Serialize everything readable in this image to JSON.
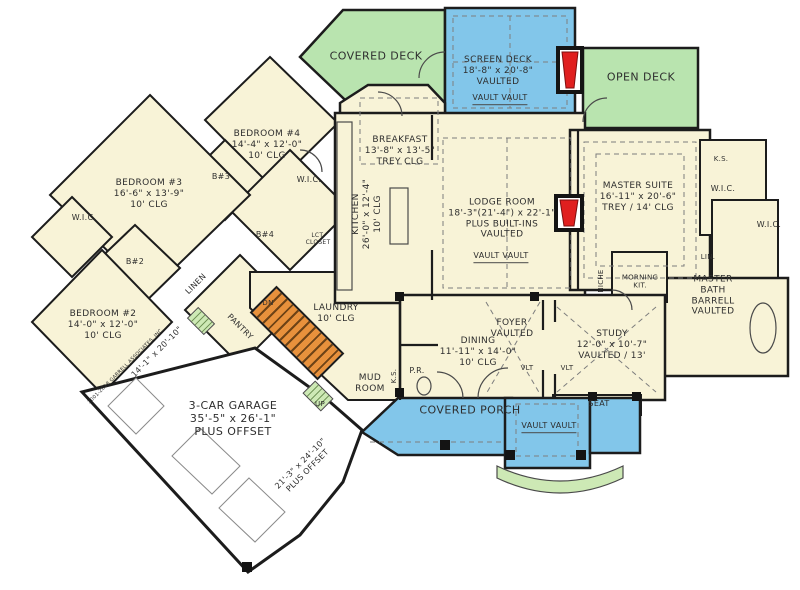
{
  "plan": {
    "decks": {
      "covered_deck": "COVERED DECK",
      "screen_deck": "SCREEN DECK\n18'-8\" x 20'-8\"\nVAULTED",
      "screen_deck_vault": "VAULT   VAULT",
      "open_deck": "OPEN DECK"
    },
    "rooms": {
      "breakfast": "BREAKFAST\n13'-8\" x 13'-5\"\nTREY CLG",
      "kitchen": "KITCHEN\n26'-0\" x 12'-4\"\n10' CLG",
      "lodge": "LODGE ROOM\n18'-3\"(21'-4\") x 22'-1\"\nPLUS BUILT-INS\nVAULTED",
      "lodge_vault": "VAULT   VAULT",
      "master_suite": "MASTER SUITE\n16'-11\" x 20'-6\"\nTREY / 14' CLG",
      "master_bath": "MASTER\nBATH\nBARRELL VAULTED",
      "morning_kit": "MORNING\nKIT.",
      "niche": "NICHE",
      "foyer": "FOYER\nVAULTED",
      "study": "STUDY\n12'-0\" x 10'-7\"\nVAULTED / 13'",
      "seat": "SEAT",
      "dining": "DINING\n11'-11\" x 14'-0\"\n10' CLG",
      "powder_room": "P.R.",
      "laundry": "LAUNDRY\n10' CLG",
      "mud_room": "MUD\nROOM",
      "pantry": "PANTRY",
      "linen": "LINEN",
      "bedroom2": "BEDROOM #2\n14'-0\" x 12'-0\"\n10' CLG",
      "bedroom3": "BEDROOM #3\n16'-6\" x 13'-9\"\n10' CLG",
      "bedroom4": "BEDROOM #4\n14'-4\" x 12'-0\"\n10' CLG",
      "bath2": "B#2",
      "bath3": "B#3",
      "bath4": "B#4",
      "wic_bed3": "W.I.C.",
      "wic_bed4": "W.I.C.",
      "wic_master1": "W.I.C.",
      "wic_master2": "W.I.C.",
      "ks_master": "K.S.",
      "ks_mud": "K.S.",
      "lin_master": "LIN.",
      "lct_closet": "LCT.\nCLOSET",
      "garage": "3-CAR GARAGE\n35'-5\" x 26'-1\"\nPLUS OFFSET",
      "garage_offset": "21'-3\" x 24'-10\"\nPLUS OFFSET",
      "covered_porch": "COVERED PORCH",
      "porch_vault": "VAULT   VAULT"
    },
    "annotations": {
      "dn": "DN",
      "up": "UP",
      "vlt_left": "VLT",
      "vlt_right": "VLT",
      "dim_side": "14'-1\" x 20'-10\"",
      "copyright": "2001-2018 GARRELL ASSOCIATES, INC."
    },
    "colors": {
      "deck_green": "#b9e4af",
      "porch_blue": "#82c6ea",
      "interior_cream": "#f8f3d7",
      "stair_orange": "#e8913c",
      "fireplace_red": "#e01f1f",
      "step_green": "#cde9b5",
      "wall": "#1c1c1c"
    }
  }
}
